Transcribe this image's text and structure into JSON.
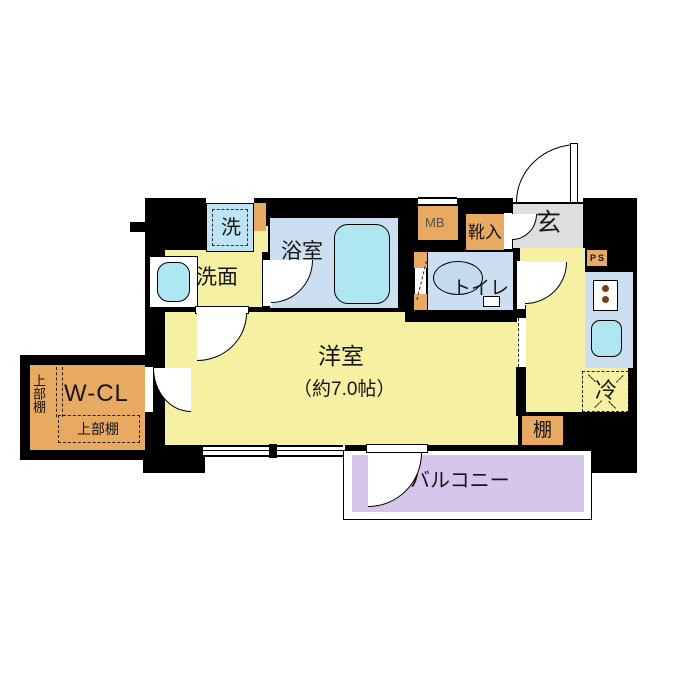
{
  "plan": {
    "type": "apartment-floor-plan",
    "labels": {
      "washer": "洗",
      "washroom": "洗面",
      "bathroom": "浴室",
      "meter_box": "MB",
      "shoe_box": "靴入",
      "entrance": "玄",
      "pipe_space": "PS",
      "toilet": "トイレ",
      "refrigerator": "冷",
      "shelf": "棚",
      "western_room": "洋室",
      "western_room_size": "（約7.0帖）",
      "walk_in_closet": "W-CL",
      "upper_shelf_side": "上部棚",
      "upper_shelf_bottom": "上部棚",
      "balcony": "バルコニー"
    },
    "colors": {
      "room_yellow": "#f6f1a2",
      "wet_blue": "#cbdff1",
      "fixture_cyan": "#aee6f2",
      "storage_orange": "#e8a960",
      "entrance_gray": "#dedede",
      "balcony_purple": "#d7c6ec",
      "wall_black": "#000000",
      "burner_brown": "#7a4015"
    }
  }
}
